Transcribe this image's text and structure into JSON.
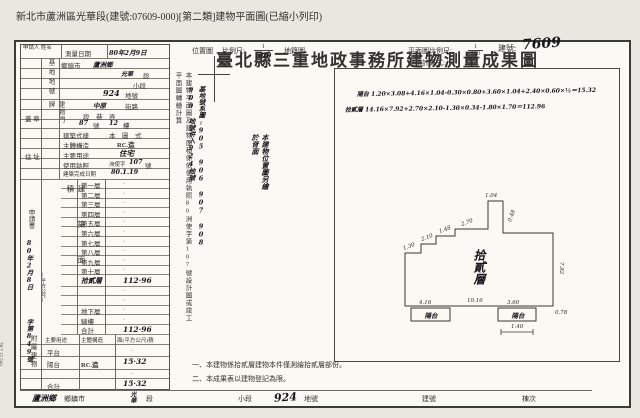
{
  "page": {
    "print_header": "新北市蘆洲區光華段(建號:07609-000)[第二類]建物平面圖(已縮小列印)"
  },
  "header": {
    "title": "臺北縣三重地政事務所建物測量成果圖",
    "building_no_label": "建號:",
    "building_no_value": "7609"
  },
  "left_table": {
    "applicant_label": "申請人 姓名",
    "survey_date_label": "測量日期",
    "survey_date_value": "80年2月9日",
    "site_section_label": "基地地號",
    "site1_label": "鄉鎮市",
    "site1_value": "蘆洲鄉",
    "site2_value": "光華",
    "site2_label": "段",
    "site3_label": "小段",
    "site4_value": "924",
    "site4_label": "地號",
    "plate_section_label": "建物門牌",
    "plate1_value": "中原",
    "plate1_label": "街路",
    "plate2_label": "段　巷　弄",
    "plate3_no1": "87",
    "plate3_no_label": "號",
    "plate3_no2": "12",
    "plate3_floor_label": "樓",
    "seal_label": "蓋 章",
    "address_label": "住 址",
    "style_label": "建築式樣",
    "style_value": "本　圖　式",
    "structure_label": "主體構造",
    "structure_value": "RC.造",
    "usage_label": "主要用途",
    "usage_value": "住宅",
    "license_label": "使用執照",
    "license_prefix": "洲使字",
    "license_no": "107",
    "license_suffix": "號",
    "completion_label": "建築完成日期",
    "completion_value": "80.1.19",
    "area_section_label": "建築面積",
    "area_unit": "(平方公尺)",
    "floors": [
      {
        "label": "第一層",
        "value": "·"
      },
      {
        "label": "第二層",
        "value": "·"
      },
      {
        "label": "第三層",
        "value": "·"
      },
      {
        "label": "第四層",
        "value": "·"
      },
      {
        "label": "第五層",
        "value": "·"
      },
      {
        "label": "第六層",
        "value": "·"
      },
      {
        "label": "第七層",
        "value": "·"
      },
      {
        "label": "第八層",
        "value": "·"
      },
      {
        "label": "第九層",
        "value": "·"
      },
      {
        "label": "第十層",
        "value": "·"
      },
      {
        "label": "拾貳層",
        "value": "112·96"
      },
      {
        "label": "",
        "value": "·"
      },
      {
        "label": "",
        "value": "·"
      },
      {
        "label": "地下層",
        "value": "·"
      },
      {
        "label": "騎樓",
        "value": "·"
      },
      {
        "label": "合計",
        "value": "112·96"
      }
    ],
    "application_label": "申請書",
    "application_date": "80年2月8日",
    "application_no": "字第849號",
    "attached_section_label": "附屬建物",
    "attached_h1": "主要用途",
    "attached_h2": "主體構造",
    "attached_h3": "面(平方公尺)積",
    "attached_rows": [
      {
        "use": "平台",
        "structure": "",
        "area": "·"
      },
      {
        "use": "陽台",
        "structure": "RC.造",
        "area": "15·32"
      },
      {
        "use": "",
        "structure": "",
        "area": "·"
      },
      {
        "use": "合計",
        "structure": "",
        "area": "15·32"
      }
    ],
    "print_code": "78.7.15,500"
  },
  "middle": {
    "remark_vertical": "本建物平面圖及建物面積係依使用執照80洲使字第107號設計圖或竣工平面圖轉繪計算",
    "parcel_note": "基地號系圖:905 906 907 908 909 地號併入924地號",
    "location_label": "位置圖",
    "scale_label": "比例尺:",
    "scale_numerator": "1",
    "scale_denominator": "500",
    "cadastre_label": "地籍圖",
    "hand_note": "本建物位置圖另繪於背面"
  },
  "plan": {
    "scale_label": "平面圖比例尺:",
    "scale_numerator": "1",
    "scale_denominator": "200",
    "calc_label": "面積計算式:",
    "formula_balcony": "陽台 1.20×3.08+4.16×1.04-0.30×0.80+3.60×1.04+2.40×0.60×½＝15.32",
    "formula_floor": "拾貳層 14.16×7.92+2.70×2.10-1.30×0.34-1.80×1.70＝112.96",
    "floor_label": "拾貳層",
    "balcony_label_left": "陽台",
    "balcony_label_right": "陽台",
    "dims": {
      "d1": "1.04",
      "d2": "0.48",
      "d3": "2.70",
      "d4": "1.48",
      "d5": "2.10",
      "d6": "1.30",
      "d7": "10.16",
      "d8": "4.16",
      "d9": "3.60",
      "d10": "1.40",
      "d11": "0.78",
      "d12": "7.92"
    }
  },
  "notes": {
    "n1": "一、本建物係拾貳層建物本件僅測繪拾貳層部份。",
    "n2": "二、本成果表以建物登記為限。"
  },
  "footer": {
    "township_hand": "蘆洲鄉",
    "township_label": "鄉鎮市",
    "section_hand": "光華",
    "section_label": "段",
    "subsection_label": "小段",
    "parcel_hand": "924",
    "parcel_label": "地號",
    "building_label": "建號",
    "unit_label": "棟次"
  }
}
